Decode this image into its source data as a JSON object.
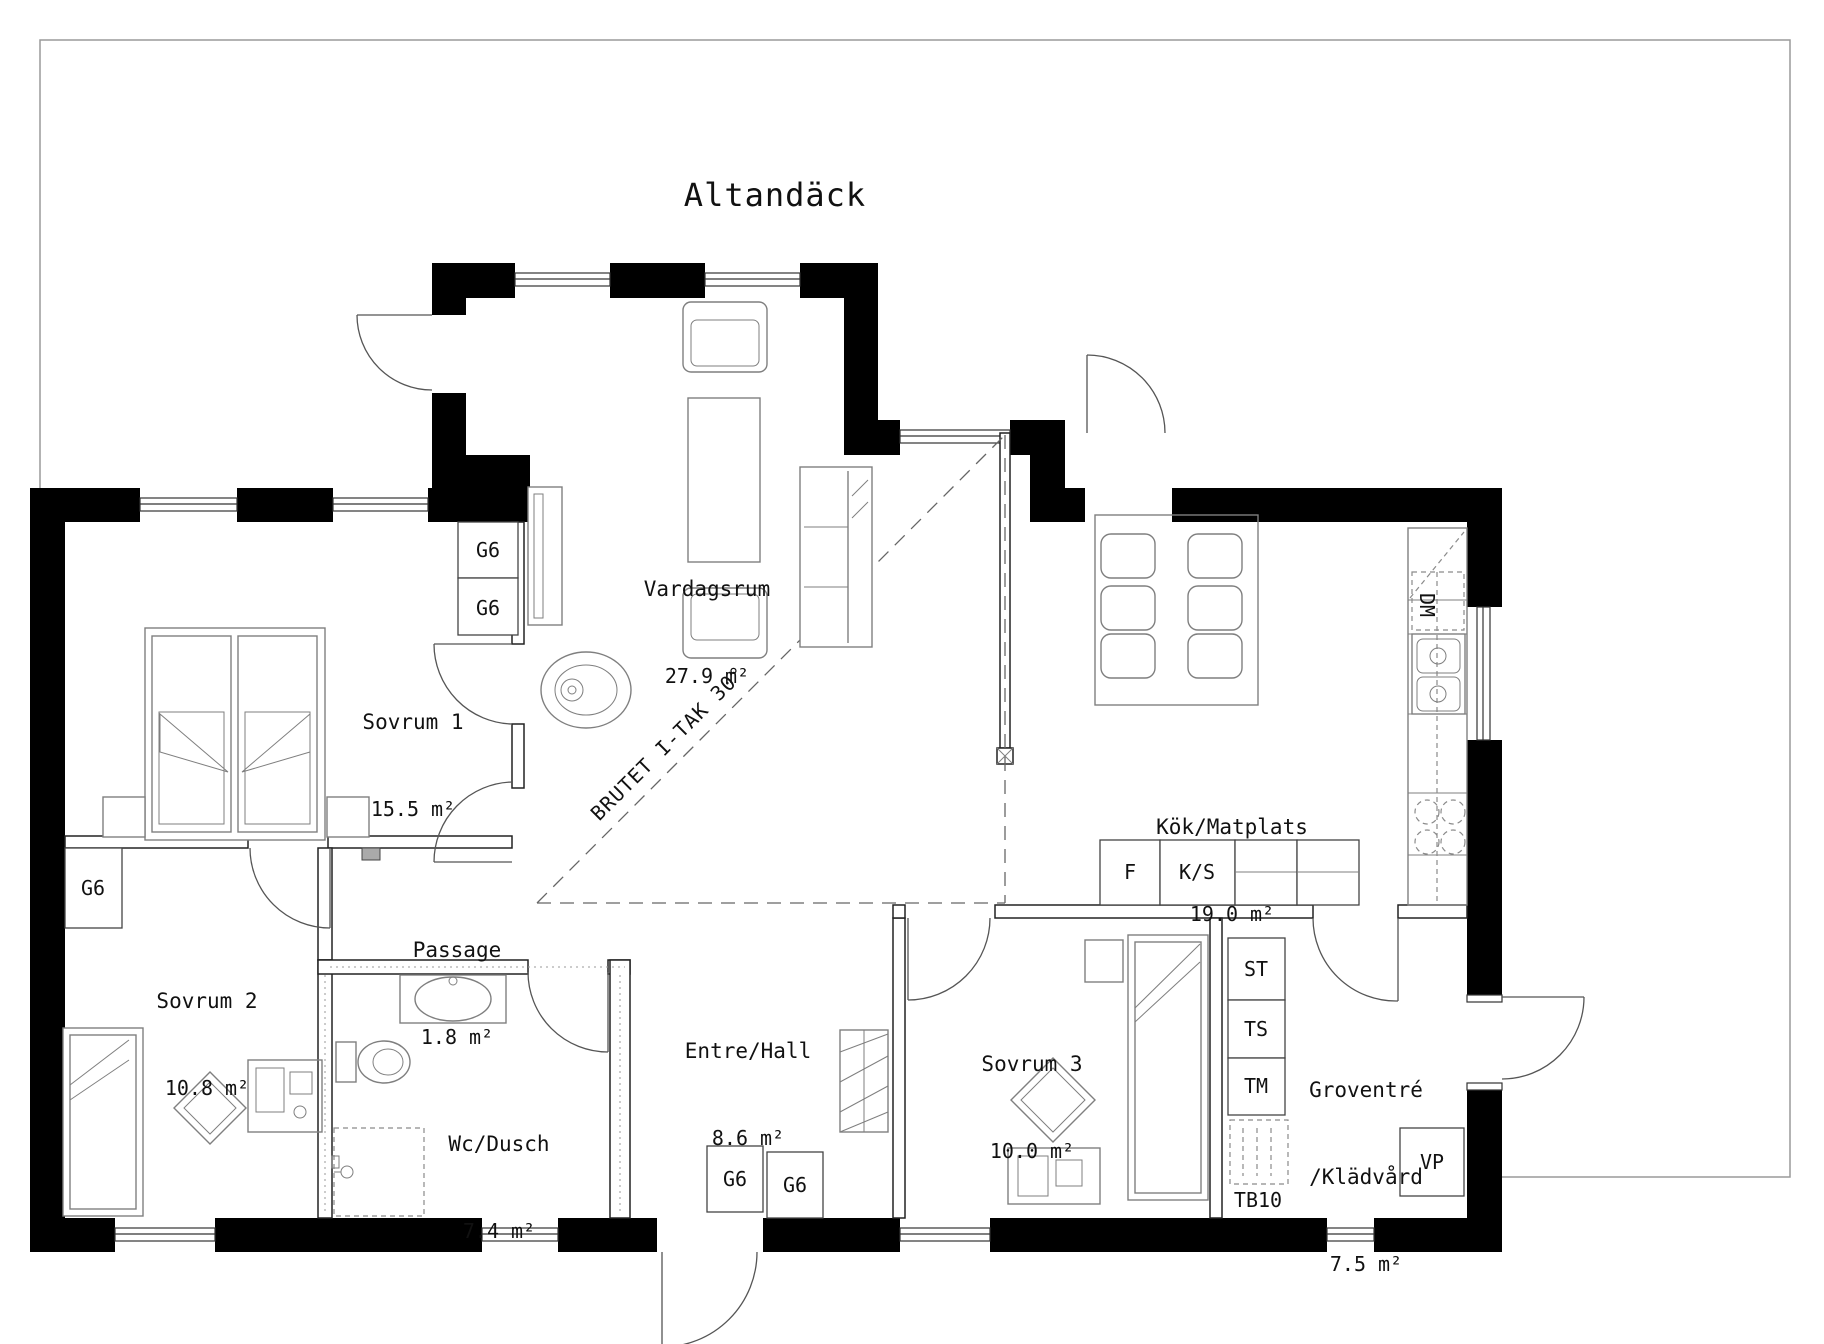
{
  "deck": {
    "label": "Altandäck"
  },
  "rooms": {
    "vardagsrum": {
      "name": "Vardagsrum",
      "area": "27.9 m²"
    },
    "sovrum1": {
      "name": "Sovrum 1",
      "area": "15.5 m²"
    },
    "sovrum2": {
      "name": "Sovrum 2",
      "area": "10.8 m²"
    },
    "passage": {
      "name": "Passage",
      "area": "1.8 m²"
    },
    "wc_dusch": {
      "name": "Wc/Dusch",
      "area": "7.4 m²"
    },
    "entre_hall": {
      "name": "Entre/Hall",
      "area": "8.6 m²"
    },
    "sovrum3": {
      "name": "Sovrum 3",
      "area": "10.0 m²"
    },
    "kok_matplats": {
      "name": "Kök/Matplats",
      "area": "19.0 m²"
    },
    "groventre": {
      "name_line1": "Groventré",
      "name_line2": "/Klädvård",
      "area": "7.5 m²"
    }
  },
  "annotations": {
    "ceiling_break": "BRUTET I-TAK 30°"
  },
  "fixtures": {
    "wardrobe_sovrum1_top": "G6",
    "wardrobe_sovrum1_bottom": "G6",
    "wardrobe_sovrum2": "G6",
    "wardrobe_hall_left": "G6",
    "wardrobe_hall_right": "G6",
    "freezer": "F",
    "fridge_pantry": "K/S",
    "st_cabinet": "ST",
    "ts_cabinet": "TS",
    "tm_cabinet": "TM",
    "tb10_bench": "TB10",
    "dishwasher": "DM",
    "heat_pump": "VP"
  }
}
